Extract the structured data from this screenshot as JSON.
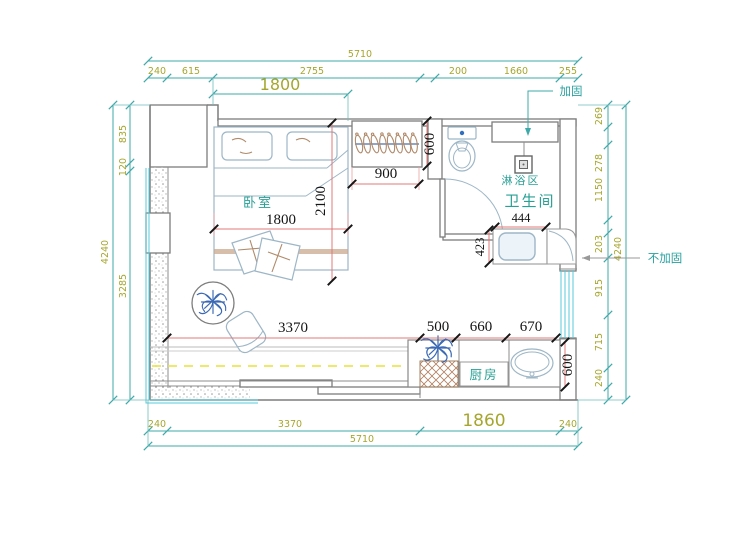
{
  "annotations": {
    "reinforced": "加固",
    "not_reinforced": "不加固"
  },
  "rooms": {
    "bedroom": "卧室",
    "bathroom": "卫生间",
    "shower_area": "淋浴区",
    "kitchen": "厨房"
  },
  "dimensions": {
    "top_overall": "5710",
    "top_segments": [
      "240",
      "615",
      "2755",
      "200",
      "1660",
      "255"
    ],
    "top_opening": "1800",
    "bottom_segments": [
      "240",
      "3370",
      "1860",
      "240"
    ],
    "bottom_overall": "5710",
    "left_overall": "4240",
    "left_segments": [
      "835",
      "120",
      "3285"
    ],
    "right_overall": "4240",
    "right_segments": [
      "269",
      "278",
      "1150",
      "203",
      "915",
      "715",
      "240"
    ],
    "bed_width": "1800",
    "bed_length": "2100",
    "closet_width": "900",
    "closet_depth": "600",
    "basin_width": "444",
    "basin_depth": "423",
    "living_span": "3370",
    "kitchen_segments": [
      "500",
      "660",
      "670"
    ],
    "kitchen_depth": "600"
  },
  "colors": {
    "dim_teal": "#3fa9a9",
    "dim_olive": "#a6a62e",
    "dim_red": "#e07878",
    "dim_black": "#141414",
    "wall_gray": "#7d7d7d",
    "furniture_blue": "#9db6c6",
    "label_teal": "#27a095",
    "window_cyan": "#55c9d9",
    "curtain_yellow": "#e9e23a",
    "plant_blue": "#3b69b4"
  }
}
